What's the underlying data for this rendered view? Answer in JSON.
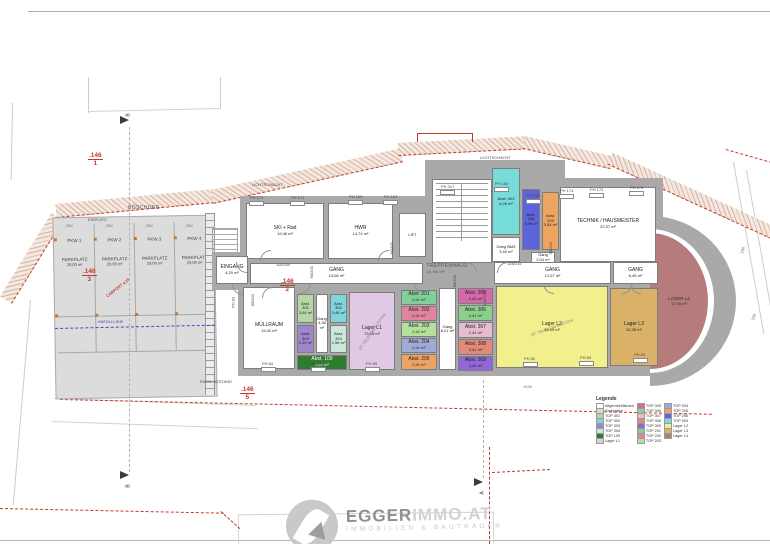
{
  "logo": {
    "brand_primary": "EGGER",
    "brand_secondary": "IMMO.AT",
    "tagline": "IMMOBILIEN & BAUTRÄGER"
  },
  "lager_l4": {
    "name": "LAGER L4",
    "area": "17,40 m²"
  },
  "legend": {
    "title": "Legende",
    "columns": [
      [
        {
          "label": "Allgemeinflächen",
          "color": "#ffffff"
        },
        {
          "label": "Parkplätze",
          "color": "#d9d9d9"
        },
        {
          "label": "TOP 301",
          "color": "#b5d6a5"
        },
        {
          "label": "TOP 302",
          "color": "#7fd6df"
        },
        {
          "label": "TOP 303",
          "color": "#9f86cd"
        },
        {
          "label": "TOP 304",
          "color": "#cce8dd"
        },
        {
          "label": "TOP 109",
          "color": "#2e7d2e"
        },
        {
          "label": "Lager L1",
          "color": "#e0c9e4"
        }
      ],
      [
        {
          "label": "TOP 305",
          "color": "#d468aa"
        },
        {
          "label": "TOP 306",
          "color": "#8ccf8c"
        },
        {
          "label": "TOP 307",
          "color": "#e6bcd2"
        },
        {
          "label": "TOP 308",
          "color": "#e28a78"
        },
        {
          "label": "TOP 309",
          "color": "#9166d6"
        },
        {
          "label": "TOP 201",
          "color": "#82cf9a"
        },
        {
          "label": "TOP 202",
          "color": "#e2849c"
        },
        {
          "label": "TOP 203",
          "color": "#b4e09c"
        }
      ],
      [
        {
          "label": "TOP 204",
          "color": "#a0aad8"
        },
        {
          "label": "TOP 205",
          "color": "#eca363"
        },
        {
          "label": "TOP 206",
          "color": "#5c63dd"
        },
        {
          "label": "TOP 003",
          "color": "#76dcd9"
        },
        {
          "label": "Lager L2",
          "color": "#f2f08c"
        },
        {
          "label": "Lager L3",
          "color": "#d9b168"
        },
        {
          "label": "Lager L4",
          "color": "#b67c7c"
        }
      ]
    ]
  },
  "parking": {
    "stalls": [
      {
        "id": "PKW 1",
        "type": "PARKPLATZ",
        "area": "29,00 m²"
      },
      {
        "id": "PKW 2",
        "type": "PARKPLATZ",
        "area": "29,00 m²"
      },
      {
        "id": "PKW 3",
        "type": "PARKPLATZ",
        "area": "29,00 m²"
      },
      {
        "id": "PKW 4",
        "type": "PARKPLATZ",
        "area": "29,00 m²"
      }
    ]
  },
  "rooms": [
    {
      "name": "SKI + Rad",
      "area": "19,46 m²",
      "x": 246,
      "y": 203,
      "w": 78,
      "h": 56,
      "color": "#ffffff"
    },
    {
      "name": "HWR",
      "area": "14,74 m²",
      "x": 328,
      "y": 203,
      "w": 65,
      "h": 56,
      "color": "#ffffff"
    },
    {
      "name": "LIFT",
      "area": "",
      "x": 399,
      "y": 213,
      "w": 27,
      "h": 44,
      "color": "#ffffff"
    },
    {
      "name": "Abst. 003",
      "area": "4,09 m²",
      "x": 492,
      "y": 168,
      "w": 28,
      "h": 67,
      "color": "#76dcd9"
    },
    {
      "name": "Gang BMZ",
      "area": "3,40 m²",
      "x": 492,
      "y": 237,
      "w": 28,
      "h": 25,
      "color": "#ffffff"
    },
    {
      "name": "Abst. 206",
      "area": "3,99 m²",
      "x": 522,
      "y": 189,
      "w": 18,
      "h": 61,
      "color": "#5c63dd"
    },
    {
      "name": "Abst. 203",
      "area": "3,04 m²",
      "x": 542,
      "y": 192,
      "w": 17,
      "h": 58,
      "color": "#eda55f"
    },
    {
      "name": "Gang",
      "area": "2,04 m²",
      "x": 531,
      "y": 252,
      "w": 24,
      "h": 11,
      "color": "#ffffff"
    },
    {
      "name": "TECHNIK / HAUSMEISTER",
      "area": "22,57 m²",
      "x": 560,
      "y": 187,
      "w": 96,
      "h": 75,
      "color": "#ffffff"
    },
    {
      "name": "EINGANG",
      "area": "4,20 m²",
      "x": 216,
      "y": 256,
      "w": 32,
      "h": 28,
      "color": "#ffffff"
    },
    {
      "name": "GANG",
      "area": "13,06 m²",
      "x": 250,
      "y": 263,
      "w": 173,
      "h": 21,
      "color": "#ffffff"
    },
    {
      "name": "GANG",
      "area": "12,07 m²",
      "x": 494,
      "y": 262,
      "w": 117,
      "h": 22,
      "color": "#ffffff"
    },
    {
      "name": "GANG",
      "area": "6,45 m²",
      "x": 613,
      "y": 262,
      "w": 45,
      "h": 22,
      "color": "#ffffff"
    },
    {
      "name": "MÜLLRAUM",
      "area": "15,42 m²",
      "x": 243,
      "y": 287,
      "w": 52,
      "h": 82,
      "color": "#ffffff"
    },
    {
      "name": "Abst. 301",
      "area": "3,04 m²",
      "x": 297,
      "y": 294,
      "w": 17,
      "h": 29,
      "color": "#b5d6a5"
    },
    {
      "name": "Abst. 303",
      "area": "2,20 m²",
      "x": 297,
      "y": 325,
      "w": 17,
      "h": 28,
      "color": "#9f86cd"
    },
    {
      "name": "Gang",
      "area": "4,36 m²",
      "x": 316,
      "y": 294,
      "w": 12,
      "h": 59,
      "color": "#ffffff"
    },
    {
      "name": "Abst. 302",
      "area": "3,46 m²",
      "x": 330,
      "y": 294,
      "w": 17,
      "h": 29,
      "color": "#7fd6df"
    },
    {
      "name": "Abst. 304",
      "area": "2,56 m²",
      "x": 330,
      "y": 325,
      "w": 17,
      "h": 28,
      "color": "#cce8dd"
    },
    {
      "name": "Abst. 109",
      "area": "3,60 m²",
      "x": 297,
      "y": 355,
      "w": 50,
      "h": 15,
      "color": "#2e7d2e",
      "tc": "#ffffff"
    },
    {
      "name": "Lager L1",
      "area": "73,55 m²",
      "x": 349,
      "y": 292,
      "w": 46,
      "h": 78,
      "color": "#e0c9e4",
      "note": "BT: TELEKOM AUSTRIA",
      "nr": -55
    },
    {
      "name": "Abst. 201",
      "area": "2,41 m²",
      "x": 401,
      "y": 290,
      "w": 36,
      "h": 15,
      "color": "#82cf9a"
    },
    {
      "name": "Abst. 202",
      "area": "2,41 m²",
      "x": 401,
      "y": 306,
      "w": 36,
      "h": 15,
      "color": "#e2849c"
    },
    {
      "name": "Abst. 203",
      "area": "2,41 m²",
      "x": 401,
      "y": 322,
      "w": 36,
      "h": 15,
      "color": "#b4e09c"
    },
    {
      "name": "Abst. 204",
      "area": "2,41 m²",
      "x": 401,
      "y": 338,
      "w": 36,
      "h": 15,
      "color": "#a0aad8"
    },
    {
      "name": "Abst. 205",
      "area": "2,41 m²",
      "x": 401,
      "y": 354,
      "w": 36,
      "h": 16,
      "color": "#eca363"
    },
    {
      "name": "Gang",
      "area": "8,21 m²",
      "x": 439,
      "y": 288,
      "w": 17,
      "h": 82,
      "color": "#ffffff"
    },
    {
      "name": "Abst. 305",
      "area": "2,41 m²",
      "x": 458,
      "y": 288,
      "w": 35,
      "h": 16,
      "color": "#d468aa"
    },
    {
      "name": "Abst. 306",
      "area": "2,41 m²",
      "x": 458,
      "y": 305,
      "w": 35,
      "h": 16,
      "color": "#8ccf8c"
    },
    {
      "name": "Abst. 307",
      "area": "2,41 m²",
      "x": 458,
      "y": 322,
      "w": 35,
      "h": 16,
      "color": "#e6bcd2"
    },
    {
      "name": "Abst. 308",
      "area": "2,41 m²",
      "x": 458,
      "y": 339,
      "w": 35,
      "h": 16,
      "color": "#e28a78"
    },
    {
      "name": "Abst. 309",
      "area": "2,41 m²",
      "x": 458,
      "y": 356,
      "w": 35,
      "h": 15,
      "color": "#9166d6"
    },
    {
      "name": "Lager L2",
      "area": "94,39 m²",
      "x": 496,
      "y": 286,
      "w": 112,
      "h": 82,
      "color": "#f2f08c",
      "note": "BT: TELEKOM AUSTRIA",
      "nr": -20
    },
    {
      "name": "Lager L3",
      "area": "32,35 m²",
      "x": 610,
      "y": 288,
      "w": 48,
      "h": 78,
      "color": "#d9b168"
    }
  ],
  "ph_labels": [
    {
      "t": "PH 171",
      "x": 250,
      "y": 196
    },
    {
      "t": "PH 171",
      "x": 291,
      "y": 196
    },
    {
      "t": "PH 169",
      "x": 349,
      "y": 195
    },
    {
      "t": "PH 167",
      "x": 384,
      "y": 195
    },
    {
      "t": "PH 317",
      "x": 441,
      "y": 185
    },
    {
      "t": "PH 180",
      "x": 495,
      "y": 182
    },
    {
      "t": "PH 183",
      "x": 527,
      "y": 194
    },
    {
      "t": "PH 174",
      "x": 560,
      "y": 189
    },
    {
      "t": "PH 174",
      "x": 590,
      "y": 188
    },
    {
      "t": "PH 174",
      "x": 630,
      "y": 186
    },
    {
      "t": "PH 84",
      "x": 262,
      "y": 362
    },
    {
      "t": "PH 85",
      "x": 312,
      "y": 362
    },
    {
      "t": "PH 89",
      "x": 366,
      "y": 362
    },
    {
      "t": "PH 82",
      "x": 524,
      "y": 357
    },
    {
      "t": "PH 83",
      "x": 580,
      "y": 356
    },
    {
      "t": "PH 89",
      "x": 634,
      "y": 353
    },
    {
      "t": "PH 82",
      "x": 228,
      "y": 300,
      "rot": -90,
      "norect": true
    }
  ],
  "door_labels": [
    {
      "t": "110/200",
      "x": 276,
      "y": 263
    },
    {
      "t": "90/200",
      "x": 306,
      "y": 270,
      "rot": -90
    },
    {
      "t": "90/200",
      "x": 386,
      "y": 246,
      "rot": -90
    },
    {
      "t": "80/200",
      "x": 449,
      "y": 279,
      "rot": -90
    },
    {
      "t": "128/215",
      "x": 507,
      "y": 262
    },
    {
      "t": "100/200",
      "x": 478,
      "y": 296,
      "rot": -90
    },
    {
      "t": "90/200",
      "x": 545,
      "y": 246,
      "rot": -90
    },
    {
      "t": "80/200",
      "x": 247,
      "y": 298,
      "rot": -90
    }
  ],
  "dim_labels": [
    {
      "t": "1930",
      "x": 523,
      "y": 385
    },
    {
      "t": "250",
      "x": 66,
      "y": 224
    },
    {
      "t": "250",
      "x": 106,
      "y": 224
    },
    {
      "t": "250",
      "x": 146,
      "y": 224
    },
    {
      "t": "250",
      "x": 186,
      "y": 224
    },
    {
      "t": "290",
      "x": 740,
      "y": 248,
      "rot": -75
    },
    {
      "t": "230",
      "x": 751,
      "y": 315,
      "rot": -75
    }
  ],
  "misc_labels": [
    {
      "text": "BÖSCHUNG",
      "x": 128,
      "y": 206,
      "misc": true
    },
    {
      "text": "EISPLATZ",
      "x": 88,
      "y": 218
    },
    {
      "text": "LICHTSCHACHT",
      "x": 252,
      "y": 183
    },
    {
      "text": "LICHTSCHACHT",
      "x": 480,
      "y": 156
    },
    {
      "text": "TREPPENHAUS",
      "sub": "15,98 m²",
      "x": 426,
      "y": 264,
      "misc": true
    },
    {
      "text": "RIGOL BESTAND",
      "x": 200,
      "y": 380
    },
    {
      "text": "ANFÜLLLINIE",
      "x": 98,
      "y": 320,
      "color": "blue"
    },
    {
      "text": "CARPORT 4,25",
      "x": 104,
      "y": 286,
      "rot": -38,
      "color": "red"
    }
  ],
  "red_plot_labels": [
    {
      "number": ".146",
      "index": "1",
      "x": 88,
      "y": 152
    },
    {
      "number": ".146",
      "index": "3",
      "x": 82,
      "y": 268
    },
    {
      "number": ".146",
      "index": "2",
      "x": 280,
      "y": 278
    },
    {
      "number": ".146",
      "index": "5",
      "x": 240,
      "y": 386
    }
  ],
  "section_markers": [
    {
      "label": "B",
      "tx": 120,
      "ty": 116,
      "lx": 127,
      "ly": 112
    },
    {
      "label": "B",
      "tx": 120,
      "ty": 471,
      "lx": 127,
      "ly": 483
    },
    {
      "label": "A",
      "tx": 474,
      "ty": 478,
      "lx": 481,
      "ly": 490
    }
  ],
  "colors": {
    "wall": "#a9a9a9",
    "boundary_red": "#c43a2e",
    "hatch_bg": "#f4e9e0",
    "parking_bg": "#dcdcdc",
    "fill_line_blue": "#4747c7",
    "lager_l4_fill": "#b67c7c"
  }
}
